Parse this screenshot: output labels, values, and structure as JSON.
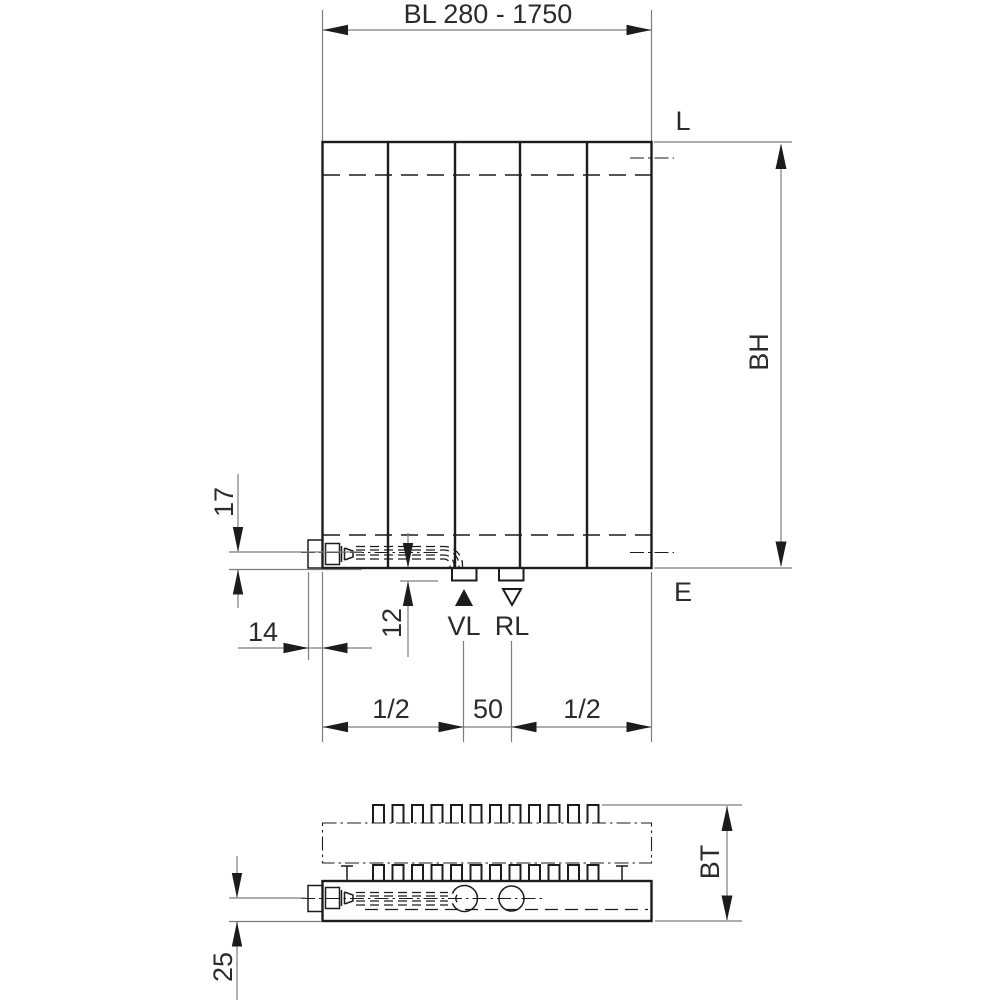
{
  "drawing_title": "Radiator dimension drawing (front view and plan view)",
  "colors": {
    "background": "#ffffff",
    "outline": "#1c1c1c",
    "dimension_line": "#7d7d7d",
    "text": "#2b2b2b"
  },
  "front_view": {
    "width_range": "BL 280 - 1750",
    "top_connection": "L",
    "bottom_connection": "E",
    "build_height": "BH",
    "pipe_center_offset": "17",
    "bracket_width": "14",
    "stub_drop": "12",
    "supply": "VL",
    "return": "RL",
    "left_half": "1/2",
    "port_spacing": "50",
    "right_half": "1/2"
  },
  "plan_view": {
    "build_depth": "BT",
    "pipe_axis_depth": "25"
  }
}
